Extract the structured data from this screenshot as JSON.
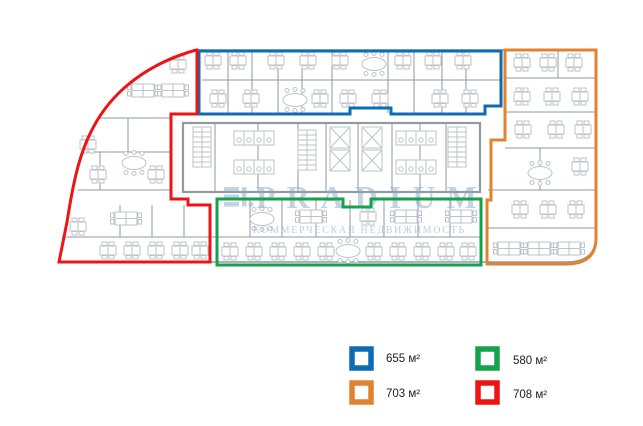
{
  "watermark": {
    "brand": "PRADIUM",
    "tagline": "КОММЕРЧЕСКАЯ НЕДВИЖИМОСТЬ"
  },
  "zones": [
    {
      "id": "blue",
      "label": "655 м²",
      "color": "#0e6cb5"
    },
    {
      "id": "green",
      "label": "580 м²",
      "color": "#16a24c"
    },
    {
      "id": "orange",
      "label": "703 м²",
      "color": "#e0822f"
    },
    {
      "id": "red",
      "label": "708 м²",
      "color": "#ec1414"
    }
  ],
  "plan": {
    "wall_color": "#929aa2",
    "furniture_color": "#bdc3ca",
    "watermark_color": "#8aa6c6"
  }
}
